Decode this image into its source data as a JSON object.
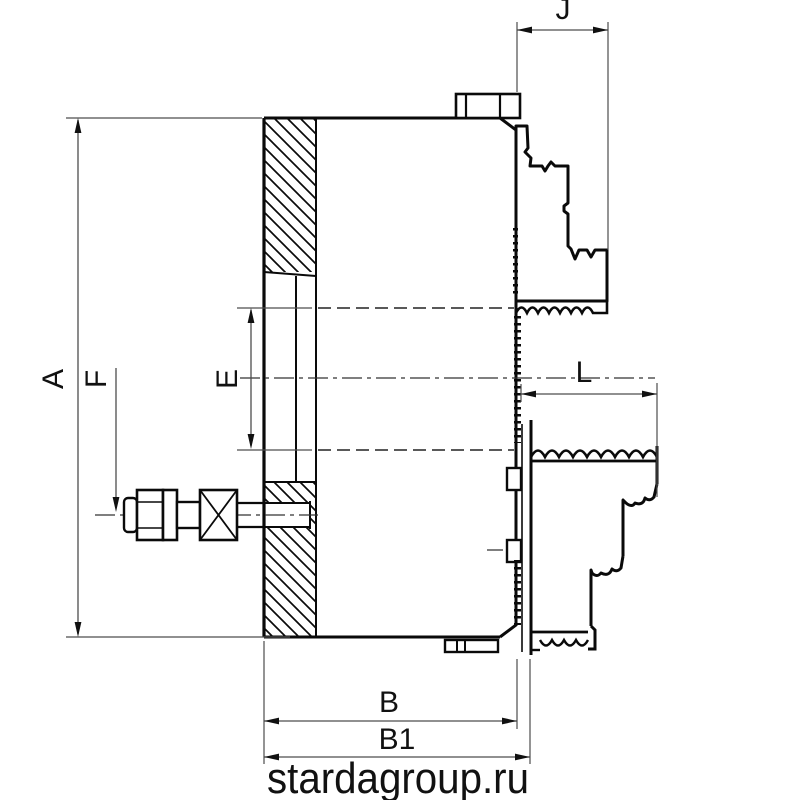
{
  "dimension_labels": {
    "a": "A",
    "f": "F",
    "e": "E",
    "j": "J",
    "l": "L",
    "b": "B",
    "b1": "B1"
  },
  "watermark": {
    "text": "stardagroup.ru",
    "color": "#8f8f8f"
  },
  "colors": {
    "outline": "#0a0a0a",
    "dimension_line": "#4d4d4d",
    "background": "#ffffff"
  }
}
